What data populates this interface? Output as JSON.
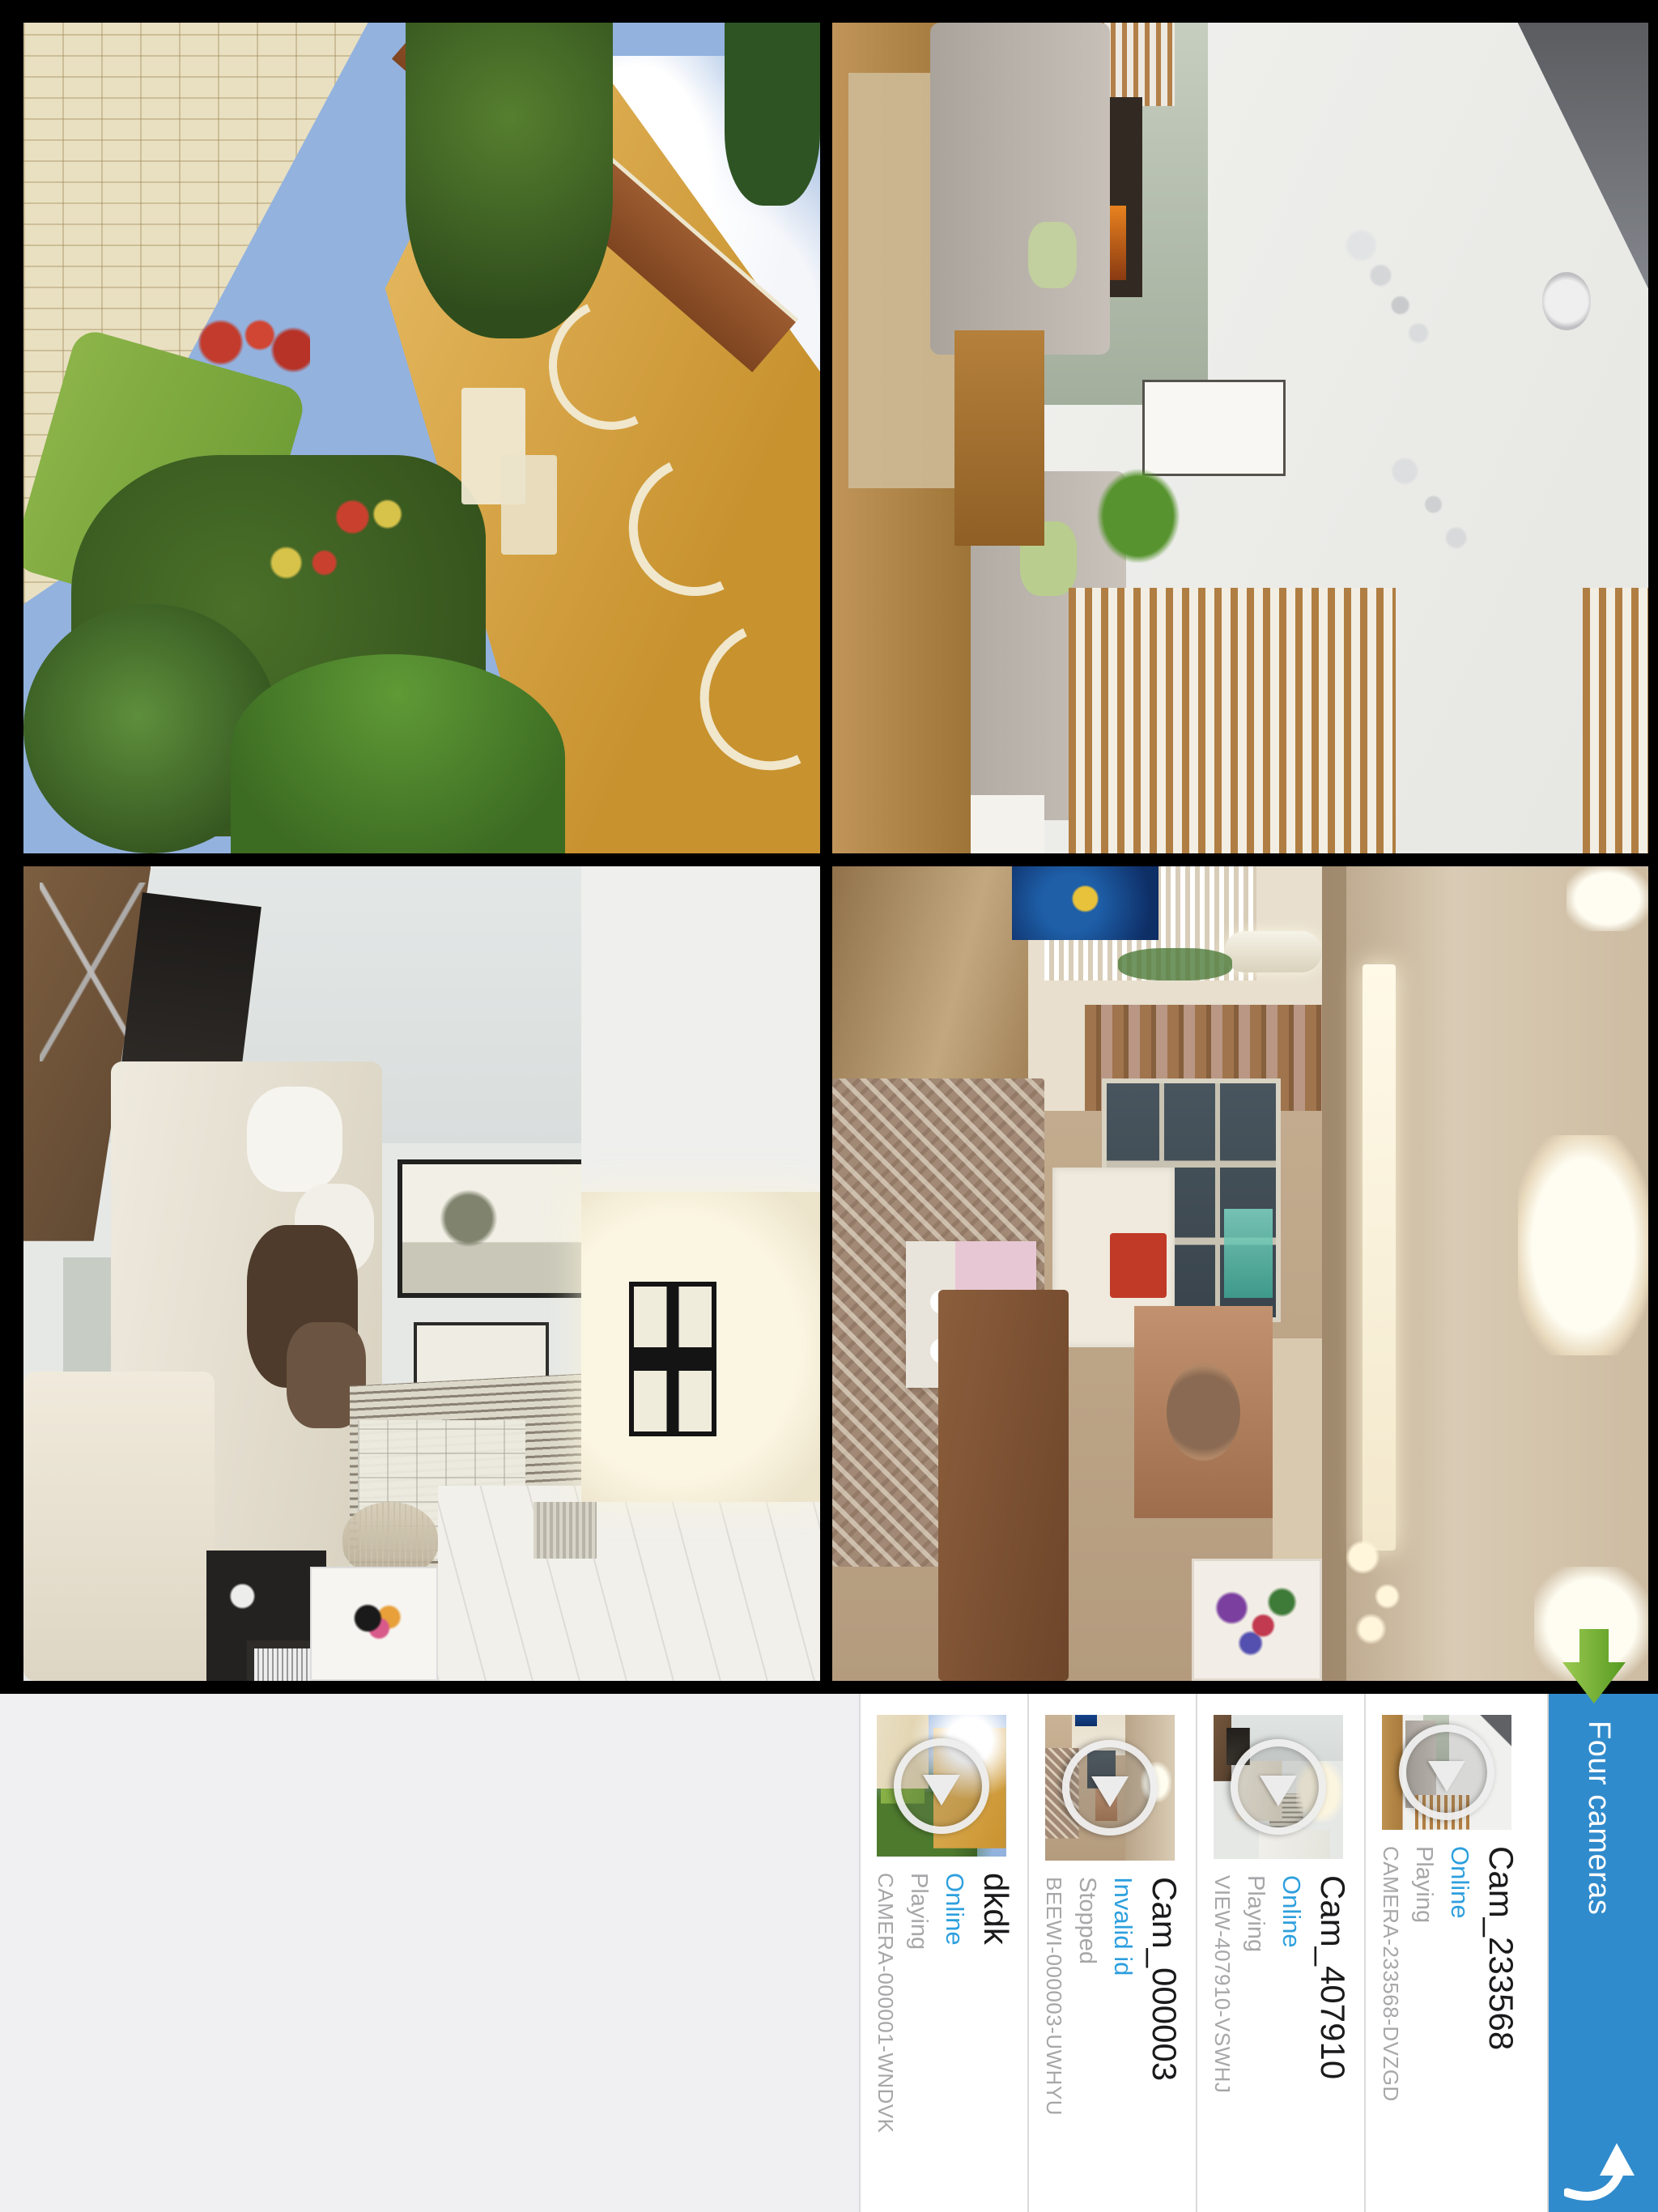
{
  "header": {
    "title": "Four cameras"
  },
  "cameras": [
    {
      "name": "Cam_233568",
      "status": "Online",
      "playback": "Playing",
      "device_id": "CAMERA-233568-DVZGD"
    },
    {
      "name": "Cam_407910",
      "status": "Online",
      "playback": "Playing",
      "device_id": "VIEW-407910-VSWHJ"
    },
    {
      "name": "Cam_000003",
      "status": "Invalid id",
      "playback": "Stopped",
      "device_id": "BEEWI-000003-UWHYU"
    },
    {
      "name": "dkdk",
      "status": "Online",
      "playback": "Playing",
      "device_id": "CAMERA-000001-WNDVK"
    }
  ],
  "icons": {
    "header_action": "curved-back-arrow",
    "grid_hint": "green-forward-arrow",
    "thumbnail_overlay": "play-button"
  },
  "colors": {
    "header_bar": "#308BCC",
    "status_text": "#2D9FDE",
    "text_primary": "#1A1A1C",
    "text_secondary": "#A7A7A9",
    "arrow_green": "#6FAE2E"
  }
}
